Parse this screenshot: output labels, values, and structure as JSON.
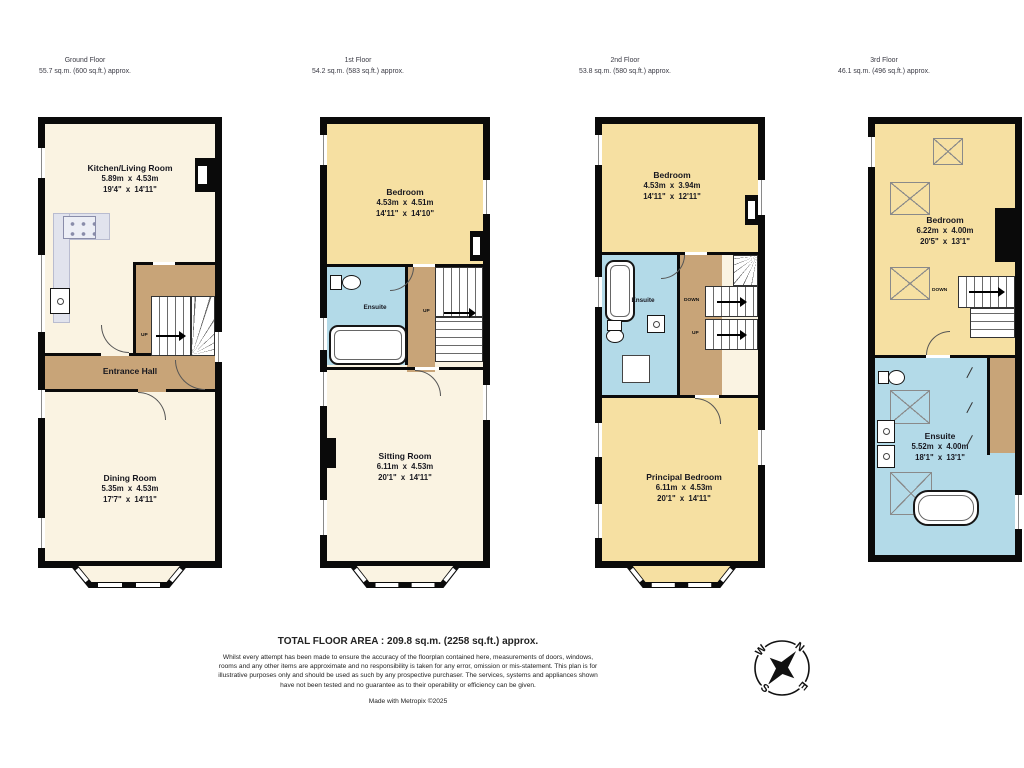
{
  "colors": {
    "wall": "#0a0a0a",
    "room_cream": "#faf3e2",
    "room_yellow": "#f6e0a2",
    "ensuite_blue": "#b3dae8",
    "hall_tan": "#c8a478",
    "counter_gray": "#e1e3ed",
    "background": "#ffffff"
  },
  "floors": [
    {
      "title": "Ground Floor",
      "area": "55.7 sq.m. (600 sq.ft.) approx.",
      "rooms": [
        {
          "name": "Kitchen/Living Room",
          "metric": "5.89m x 4.53m",
          "imperial": "19'4\" x 14'11\""
        },
        {
          "name": "Entrance Hall"
        },
        {
          "name": "Dining Room",
          "metric": "5.35m x 4.53m",
          "imperial": "17'7\" x 14'11\""
        }
      ],
      "stairs": {
        "up": "UP"
      }
    },
    {
      "title": "1st Floor",
      "area": "54.2 sq.m. (583 sq.ft.) approx.",
      "rooms": [
        {
          "name": "Bedroom",
          "metric": "4.53m x 4.51m",
          "imperial": "14'11\" x 14'10\""
        },
        {
          "name": "Ensuite"
        },
        {
          "name": "Sitting Room",
          "metric": "6.11m x 4.53m",
          "imperial": "20'1\" x 14'11\""
        }
      ],
      "stairs": {
        "up": "UP"
      }
    },
    {
      "title": "2nd Floor",
      "area": "53.8 sq.m. (580 sq.ft.) approx.",
      "rooms": [
        {
          "name": "Bedroom",
          "metric": "4.53m x 3.94m",
          "imperial": "14'11\" x 12'11\""
        },
        {
          "name": "Ensuite"
        },
        {
          "name": "Principal Bedroom",
          "metric": "6.11m x 4.53m",
          "imperial": "20'1\" x 14'11\""
        }
      ],
      "stairs": {
        "down": "DOWN",
        "up": "UP"
      }
    },
    {
      "title": "3rd Floor",
      "area": "46.1 sq.m. (496 sq.ft.) approx.",
      "rooms": [
        {
          "name": "Bedroom",
          "metric": "6.22m x 4.00m",
          "imperial": "20'5\" x 13'1\""
        },
        {
          "name": "Ensuite",
          "metric": "5.52m x 4.00m",
          "imperial": "18'1\" x 13'1\""
        }
      ],
      "stairs": {
        "down": "DOWN"
      }
    }
  ],
  "footer": {
    "total": "TOTAL FLOOR AREA : 209.8 sq.m. (2258 sq.ft.) approx.",
    "disclaimer": "Whilst every attempt has been made to ensure the accuracy of the floorplan contained here, measurements of doors, windows, rooms and any other items are approximate and no responsibility is taken for any error, omission or mis-statement. This plan is for illustrative purposes only and should be used as such by any prospective purchaser. The services, systems and appliances shown have not been tested and no guarantee as to their operability or efficiency can be given.",
    "credit": "Made with Metropix ©2025"
  },
  "compass": {
    "n": "N",
    "w": "W",
    "s": "S",
    "e": "E"
  }
}
